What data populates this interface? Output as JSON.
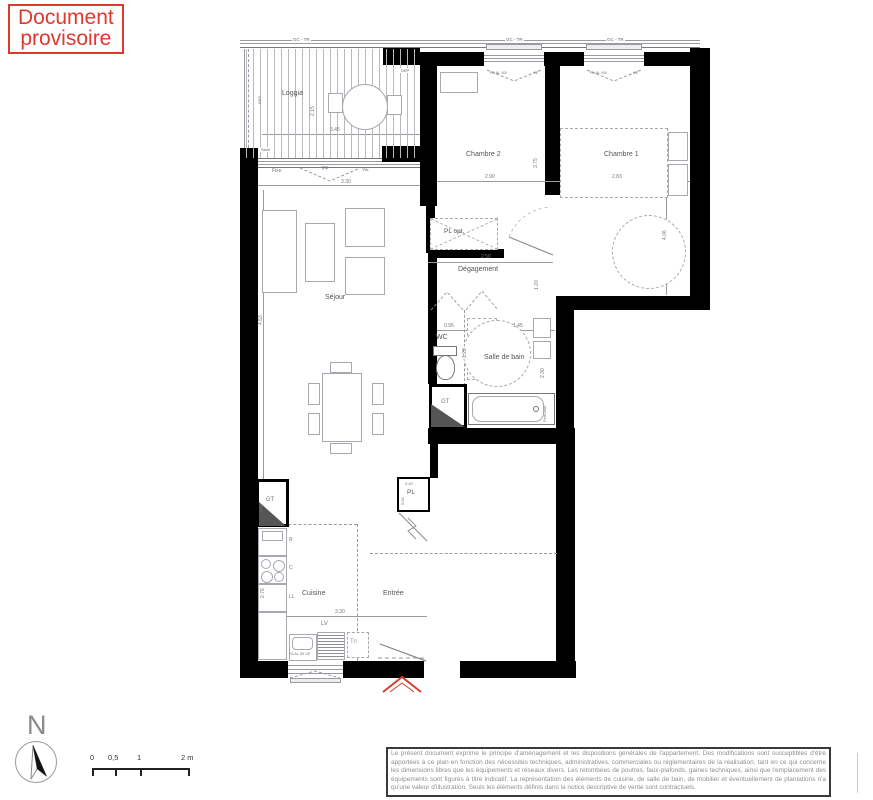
{
  "banner": {
    "line1": "Document",
    "line2": "provisoire"
  },
  "rooms": {
    "loggia": "Loggia",
    "chambre2": "Chambre 2",
    "chambre1": "Chambre 1",
    "sejour": "Séjour",
    "degagement": "Dégagement",
    "wc": "WC",
    "salle_de_bain": "Salle de bain",
    "cuisine": "Cuisine",
    "entree": "Entrée"
  },
  "annotations": {
    "gc_tr": "GC - TR",
    "dep": "DEP",
    "seuil": "Seuil",
    "bep": "BEP",
    "fixe": "Fixe",
    "pf": "PF",
    "ve": "VE",
    "window_label": "FA  AL 50l",
    "kitchen_window": "FA   AL 50   VE",
    "pl_opt": "PL opt.",
    "pl": "PL",
    "gt": "GT",
    "lv": "LV",
    "tri": "Tri",
    "fridge": "R",
    "cooking": "C",
    "washer": "LL",
    "pare_bain": "Pare-bain"
  },
  "dims": {
    "loggia_width": "3.45",
    "loggia_depth": "2.15",
    "bay_width": "3.30",
    "chambre2_width": "2.90",
    "chambre2_depth": "3.75",
    "chambre1_width": "2.83",
    "chambre1_depth": "4.06",
    "degagement_width": "2.50",
    "degagement_depth": "1.20",
    "wc_width": "0.95",
    "wc_depth": "1.28",
    "sdb_width": "1.45",
    "sdb_depth": "2.30",
    "sejour_depth": "4.53",
    "cuisine_depth": "2.76",
    "cuisine_width": "3.30",
    "gt_height": "0.80",
    "pl_width": "0.40",
    "pl_depth": "0.65"
  },
  "compass": {
    "north": "N"
  },
  "scale_bar": {
    "t0": "0",
    "t05": "0,5",
    "t1": "1",
    "t2": "2 m"
  },
  "disclaimer": "Le présent document exprime le principe d'aménagement et les dispositions générales de l'appartement. Des modifications sont susceptibles d'être apportées à ce plan en fonction des nécessités techniques, administratives, commerciales ou réglementaires de la réalisation, tant en ce qui concerne les dimensions libres que les équipements et réseaux divers. Les retombées de poutres, faux-plafonds, gaines techniques, ainsi que l'emplacement des équipements sont figurés à titre indicatif. La représentation des éléments de cuisine, de salle de bain, de mobilier et éventuellement de plantations n'a qu'une valeur d'illustration. Seuls les éléments définis dans la notice descriptive de vente sont contractuels.",
  "colors": {
    "accent_red": "#df382e",
    "wall_black": "#000000",
    "line_gray": "#9a9aa0",
    "text_gray": "#555555"
  }
}
